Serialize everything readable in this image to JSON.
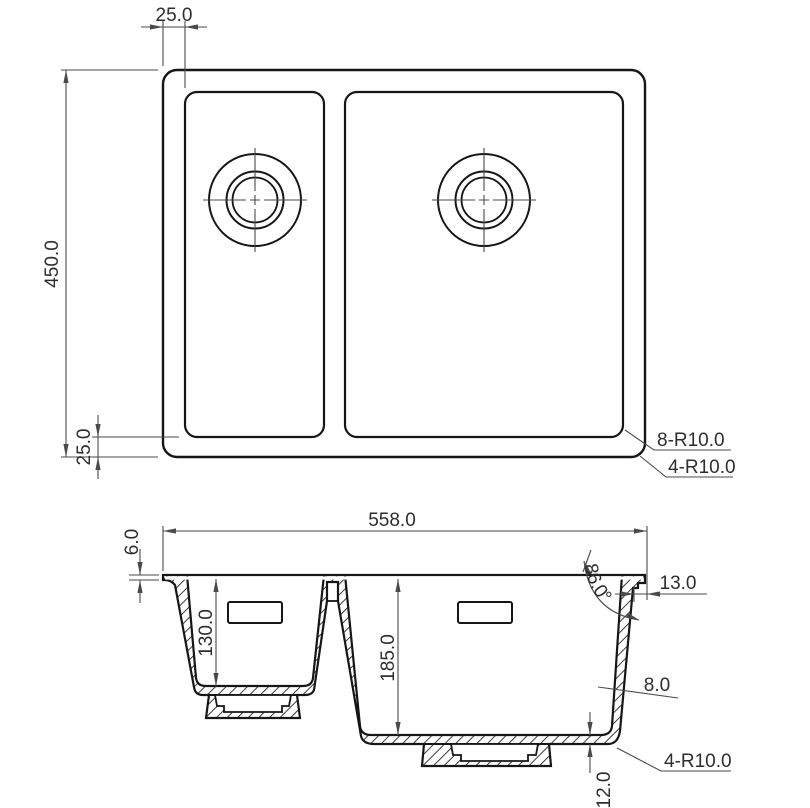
{
  "meta": {
    "background": "#ffffff",
    "object_line_color": "#161616",
    "dimension_line_color": "#4a4a4a",
    "text_color": "#2e2e2e"
  },
  "top_view": {
    "dim_rim_offset_top": "25.0",
    "dim_overall_height": "450.0",
    "dim_rim_offset_bottom": "25.0",
    "note_bowl_corner_radius": "8-R10.0",
    "note_outer_corner_radius": "4-R10.0"
  },
  "section_view": {
    "dim_overall_width": "558.0",
    "dim_rim_thickness": "6.0",
    "dim_small_bowl_depth": "130.0",
    "dim_large_bowl_depth": "185.0",
    "dim_rim_overhang": "13.0",
    "dim_wall_thickness": "8.0",
    "dim_wall_angle": "86.0°",
    "dim_base_thickness": "12.0",
    "note_bottom_corner_radius": "4-R10.0"
  }
}
